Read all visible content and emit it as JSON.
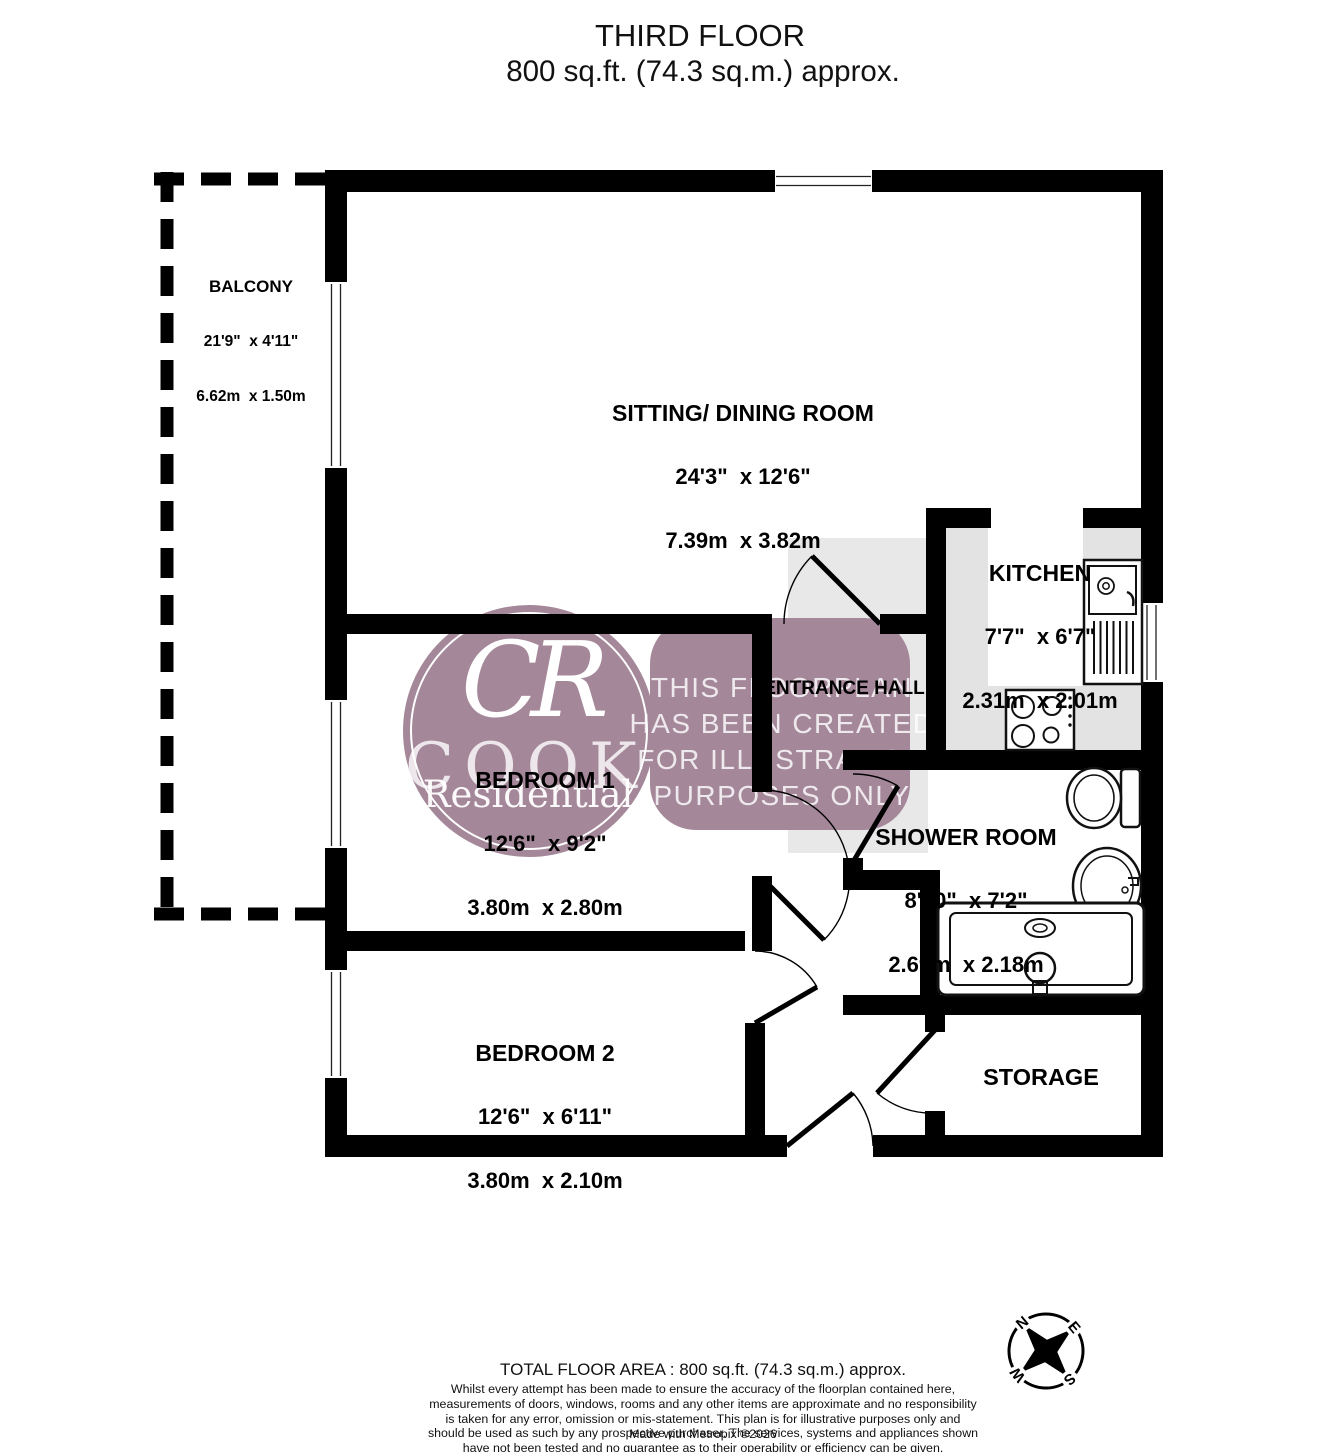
{
  "title": {
    "line1": "THIRD FLOOR",
    "line2": "800 sq.ft. (74.3 sq.m.) approx."
  },
  "rooms": {
    "balcony": {
      "name": "BALCONY",
      "imperial": "21'9\"  x 4'11\"",
      "metric": "6.62m  x 1.50m"
    },
    "sitting": {
      "name": "SITTING/ DINING ROOM",
      "imperial": "24'3\"  x 12'6\"",
      "metric": "7.39m  x 3.82m"
    },
    "kitchen": {
      "name": "KITCHEN",
      "imperial": "7'7\"  x 6'7\"",
      "metric": "2.31m  x 2.01m"
    },
    "entrance": {
      "name": "ENTRANCE HALL"
    },
    "bedroom1": {
      "name": "BEDROOM 1",
      "imperial": "12'6\"  x 9'2\"",
      "metric": "3.80m  x 2.80m"
    },
    "shower": {
      "name": "SHOWER ROOM",
      "imperial": "8'10\"  x 7'2\"",
      "metric": "2.69m  x 2.18m"
    },
    "bedroom2": {
      "name": "BEDROOM 2",
      "imperial": "12'6\"  x 6'11\"",
      "metric": "3.80m  x 2.10m"
    },
    "storage": {
      "name": "STORAGE"
    }
  },
  "watermark": {
    "initials": "CR",
    "brand_top": "COOK",
    "brand_bottom": "Residential",
    "notice": [
      "THIS FLOORPLAN",
      "HAS BEEN CREATED",
      "FOR ILLUSTRATION",
      "PURPOSES ONLY"
    ]
  },
  "compass": {
    "n": "N",
    "e": "E",
    "s": "S",
    "w": "W"
  },
  "footer": {
    "total": "TOTAL FLOOR AREA : 800 sq.ft. (74.3 sq.m.) approx.",
    "disclaimer": "Whilst every attempt has been made to ensure the accuracy of the floorplan contained here, measurements of doors, windows, rooms and any other items are approximate and no responsibility is taken for any error, omission or mis-statement. This plan is for illustrative purposes only and should be used as such by any prospective purchaser. The services, systems and appliances shown have not been tested and no guarantee as to their operability or efficiency can be given.",
    "credit": "Made with Metropix ©2026"
  },
  "colors": {
    "wall": "#000000",
    "watermark": "#a5879a",
    "kitchen_floor": "#e3e3e3"
  }
}
